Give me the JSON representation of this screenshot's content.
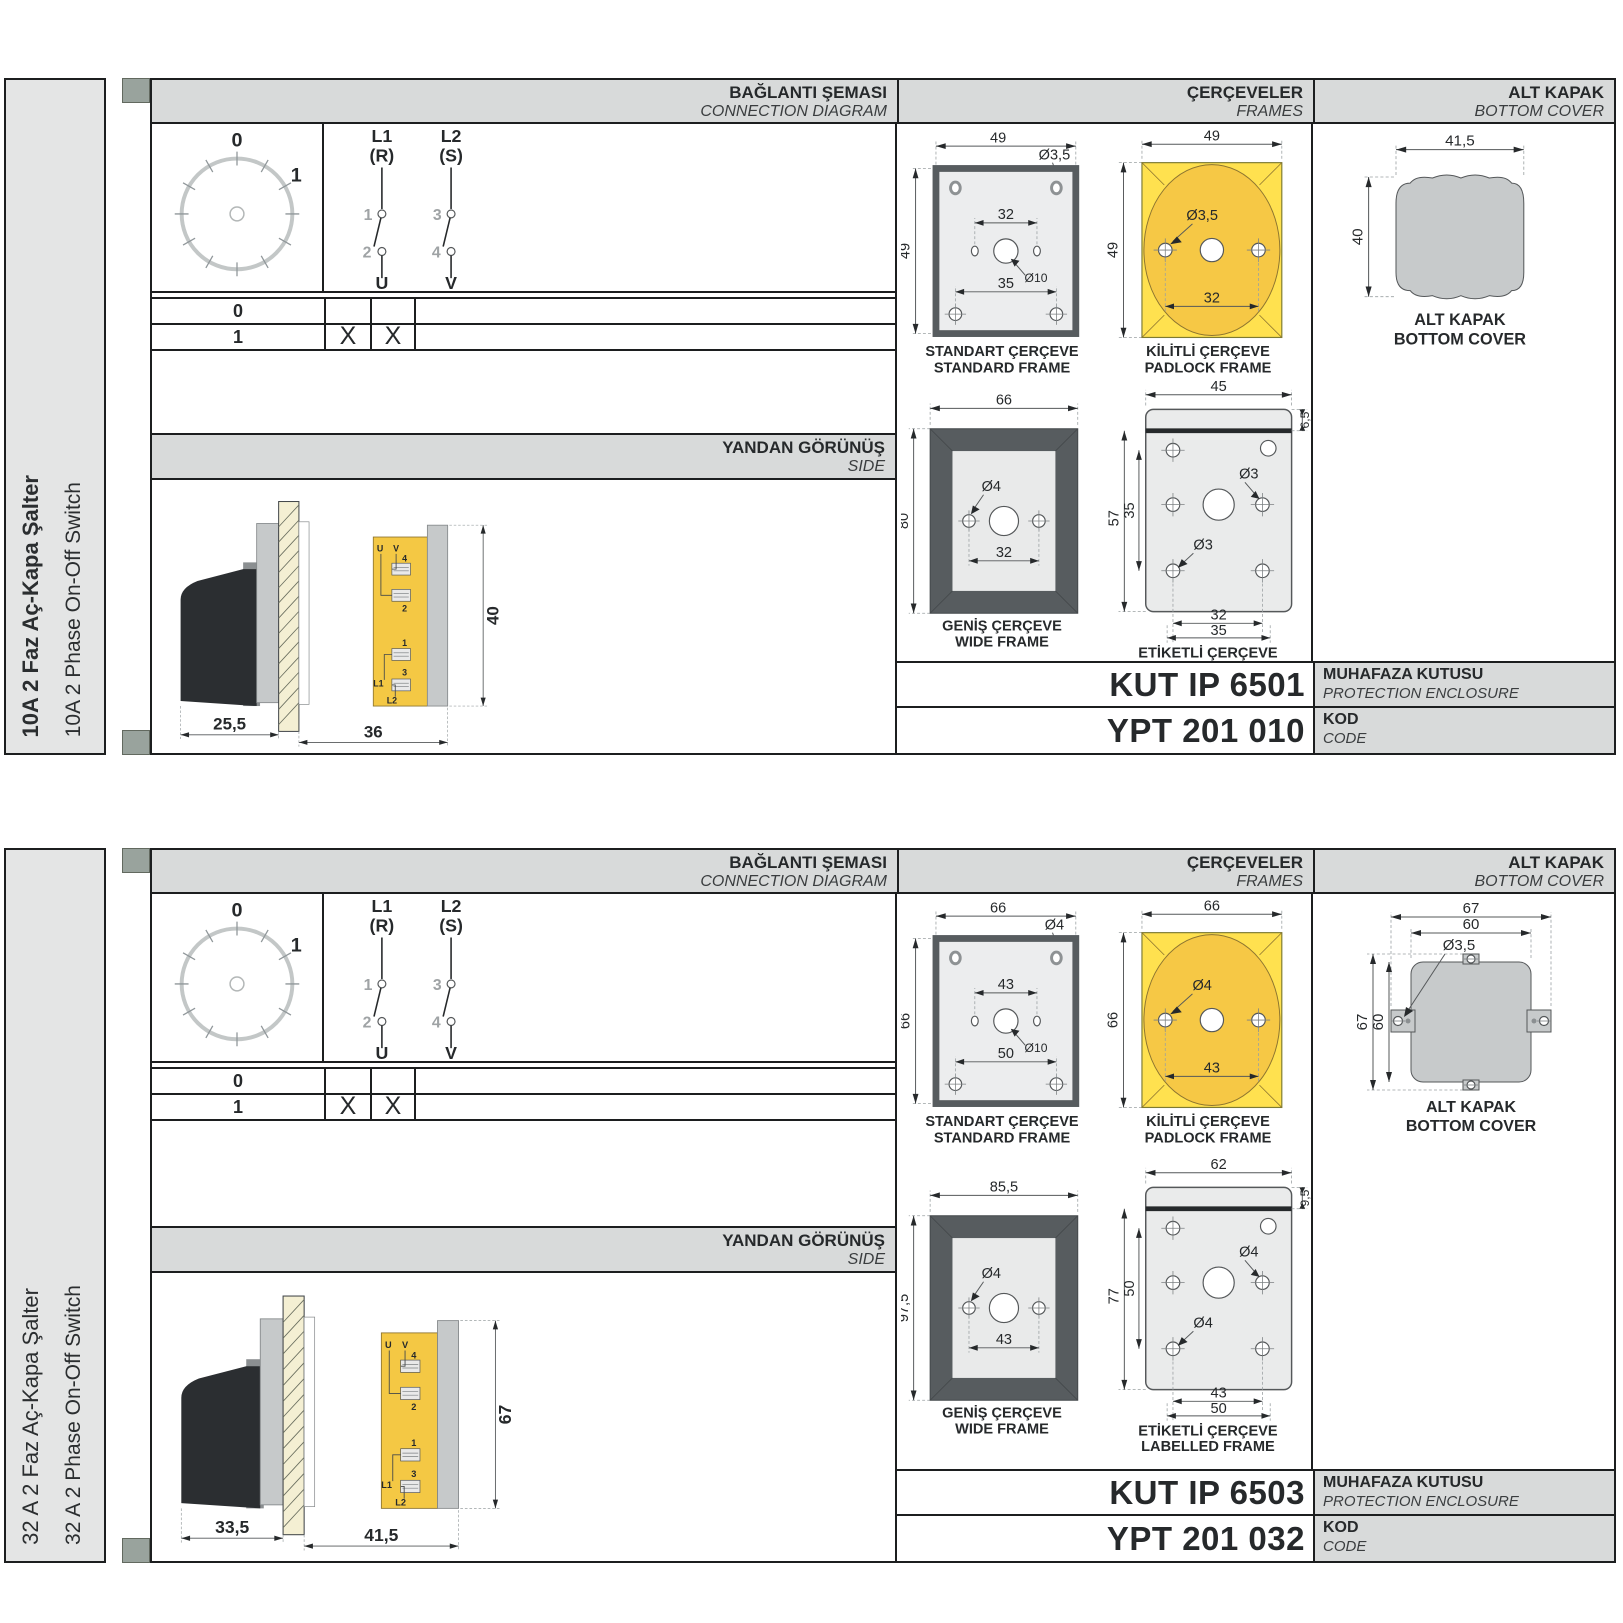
{
  "p0": {
    "side_tr": "10A 2 Faz Aç-Kapa Şalter",
    "side_en": "10A 2 Phase On-Off Switch",
    "hdr": {
      "c1t": "BAĞLANTI ŞEMASI",
      "c1e": "CONNECTION DIAGRAM",
      "c2t": "ÇERÇEVELER",
      "c2e": "FRAMES",
      "c3t": "ALT KAPAK",
      "c3e": "BOTTOM COVER"
    },
    "dial": {
      "z": "0",
      "o": "1"
    },
    "sw": {
      "a1": "L1",
      "a2": "(R)",
      "ac1": "1",
      "ac2": "2",
      "at": "U",
      "b1": "L2",
      "b2": "(S)",
      "bc1": "3",
      "bc2": "4",
      "bt": "V"
    },
    "tbl": {
      "r0": "0",
      "r1": "1",
      "x1": "X",
      "x2": "X"
    },
    "sv": {
      "t": "YANDAN GÖRÜNÜŞ",
      "e": "SIDE",
      "d1": "25,5",
      "d2": "36",
      "dh": "40",
      "u": "U",
      "v": "V",
      "n1": "1",
      "n2": "2",
      "n3": "3",
      "n4": "4",
      "l1": "L1",
      "l2": "L2"
    },
    "fr": {
      "std": {
        "t": "STANDART ÇERÇEVE",
        "e": "STANDARD FRAME",
        "w": "49",
        "h": "49",
        "s1": "32",
        "s2": "35",
        "hole": "Ø3,5",
        "ctr": "Ø10"
      },
      "pad": {
        "t": "KİLİTLİ ÇERÇEVE",
        "e": "PADLOCK FRAME",
        "w": "49",
        "h": "49",
        "s1": "32",
        "hole": "Ø3,5"
      },
      "wide": {
        "t": "GENİŞ ÇERÇEVE",
        "e": "WIDE FRAME",
        "w": "66",
        "h": "80",
        "s1": "32",
        "hole": "Ø4"
      },
      "lab": {
        "t": "ETİKETLİ ÇERÇEVE",
        "e": "LABELLED FRAME",
        "w": "45",
        "h": "57",
        "h2": "35",
        "band": "6,5",
        "s1": "32",
        "s2": "35",
        "hole1": "Ø3",
        "hole2": "Ø3"
      }
    },
    "cov": {
      "t": "ALT KAPAK",
      "e": "BOTTOM COVER",
      "w": "41,5",
      "h": "40"
    },
    "code": {
      "enc": "KUT IP 6501",
      "enct": "MUHAFAZA KUTUSU",
      "ence": "PROTECTION ENCLOSURE",
      "kod": "YPT 201 010",
      "kodt": "KOD",
      "kode": "CODE"
    }
  },
  "p1": {
    "side_tr": "32 A 2 Faz Aç-Kapa Şalter",
    "side_en": "32 A 2 Phase On-Off Switch",
    "hdr": {
      "c1t": "BAĞLANTI ŞEMASI",
      "c1e": "CONNECTION DIAGRAM",
      "c2t": "ÇERÇEVELER",
      "c2e": "FRAMES",
      "c3t": "ALT KAPAK",
      "c3e": "BOTTOM COVER"
    },
    "dial": {
      "z": "0",
      "o": "1"
    },
    "sw": {
      "a1": "L1",
      "a2": "(R)",
      "ac1": "1",
      "ac2": "2",
      "at": "U",
      "b1": "L2",
      "b2": "(S)",
      "bc1": "3",
      "bc2": "4",
      "bt": "V"
    },
    "tbl": {
      "r0": "0",
      "r1": "1",
      "x1": "X",
      "x2": "X"
    },
    "sv": {
      "t": "YANDAN GÖRÜNÜŞ",
      "e": "SIDE",
      "d1": "33,5",
      "d2": "41,5",
      "dh": "67",
      "u": "U",
      "v": "V",
      "n1": "1",
      "n2": "2",
      "n3": "3",
      "n4": "4",
      "l1": "L1",
      "l2": "L2"
    },
    "fr": {
      "std": {
        "t": "STANDART ÇERÇEVE",
        "e": "STANDARD FRAME",
        "w": "66",
        "h": "66",
        "s1": "43",
        "s2": "50",
        "hole": "Ø4",
        "ctr": "Ø10"
      },
      "pad": {
        "t": "KİLİTLİ ÇERÇEVE",
        "e": "PADLOCK FRAME",
        "w": "66",
        "h": "66",
        "s1": "43",
        "hole": "Ø4"
      },
      "wide": {
        "t": "GENİŞ ÇERÇEVE",
        "e": "WIDE FRAME",
        "w": "85,5",
        "h": "97,5",
        "s1": "43",
        "hole": "Ø4"
      },
      "lab": {
        "t": "ETİKETLİ ÇERÇEVE",
        "e": "LABELLED FRAME",
        "w": "62",
        "h": "77",
        "h2": "50",
        "band": "9,5",
        "s1": "43",
        "s2": "50",
        "hole1": "Ø4",
        "hole2": "Ø4"
      }
    },
    "cov": {
      "t": "ALT KAPAK",
      "e": "BOTTOM COVER",
      "w1": "67",
      "w2": "60",
      "h1": "67",
      "h2": "60",
      "hole": "Ø3,5"
    },
    "code": {
      "enc": "KUT IP 6503",
      "enct": "MUHAFAZA KUTUSU",
      "ence": "PROTECTION ENCLOSURE",
      "kod": "YPT 201 032",
      "kodt": "KOD",
      "kode": "CODE"
    }
  },
  "colors": {
    "accent_yellow": "#ffe14f",
    "circle_yellow": "#f6c845",
    "frame_dark": "#575c5f",
    "header_grey": "#d8dada",
    "cover_grey": "#c7cacb"
  }
}
